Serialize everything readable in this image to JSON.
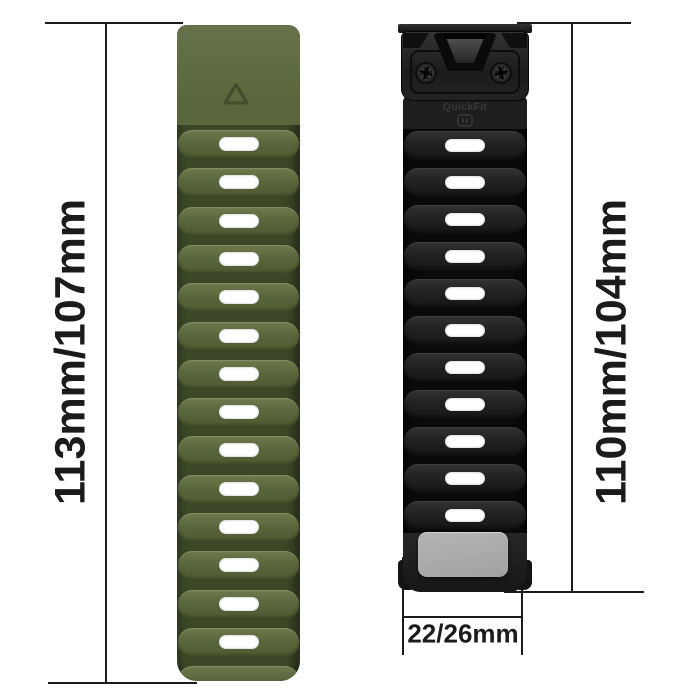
{
  "background": "#ffffff",
  "product": {
    "left_strap": {
      "description": "Army green silicone watch strap, back side with triangle marker and ventilation slots",
      "length_label": "113mm/107mm",
      "slot_count": 14,
      "marker_icon": "triangle-icon",
      "colors": {
        "ridge_light": "#6e7a4c",
        "ridge_mid": "#5a673c",
        "ridge_dark": "#4d5931",
        "groove": "#3c4727"
      }
    },
    "right_strap": {
      "description": "Black silicone watch strap, front side with QuickFit buckle, two screws and metal plate",
      "length_label": "110mm/104mm",
      "slot_count": 11,
      "buckle_label": "QuickFit",
      "buckle_logo_icon": "quickfit-logo-icon",
      "screw_count": 2,
      "colors": {
        "ridge_light": "#333333",
        "ridge_mid": "#232323",
        "ridge_dark": "#161616",
        "groove": "#0a0a0a",
        "plate": "#b4b4b4"
      }
    },
    "width_label": "22/26mm"
  },
  "annotation": {
    "left_length": "113mm/107mm",
    "right_length": "110mm/104mm",
    "lug_width": "22/26mm",
    "line_color": "#1b1b1b",
    "text_color": "#1b1b1b"
  }
}
